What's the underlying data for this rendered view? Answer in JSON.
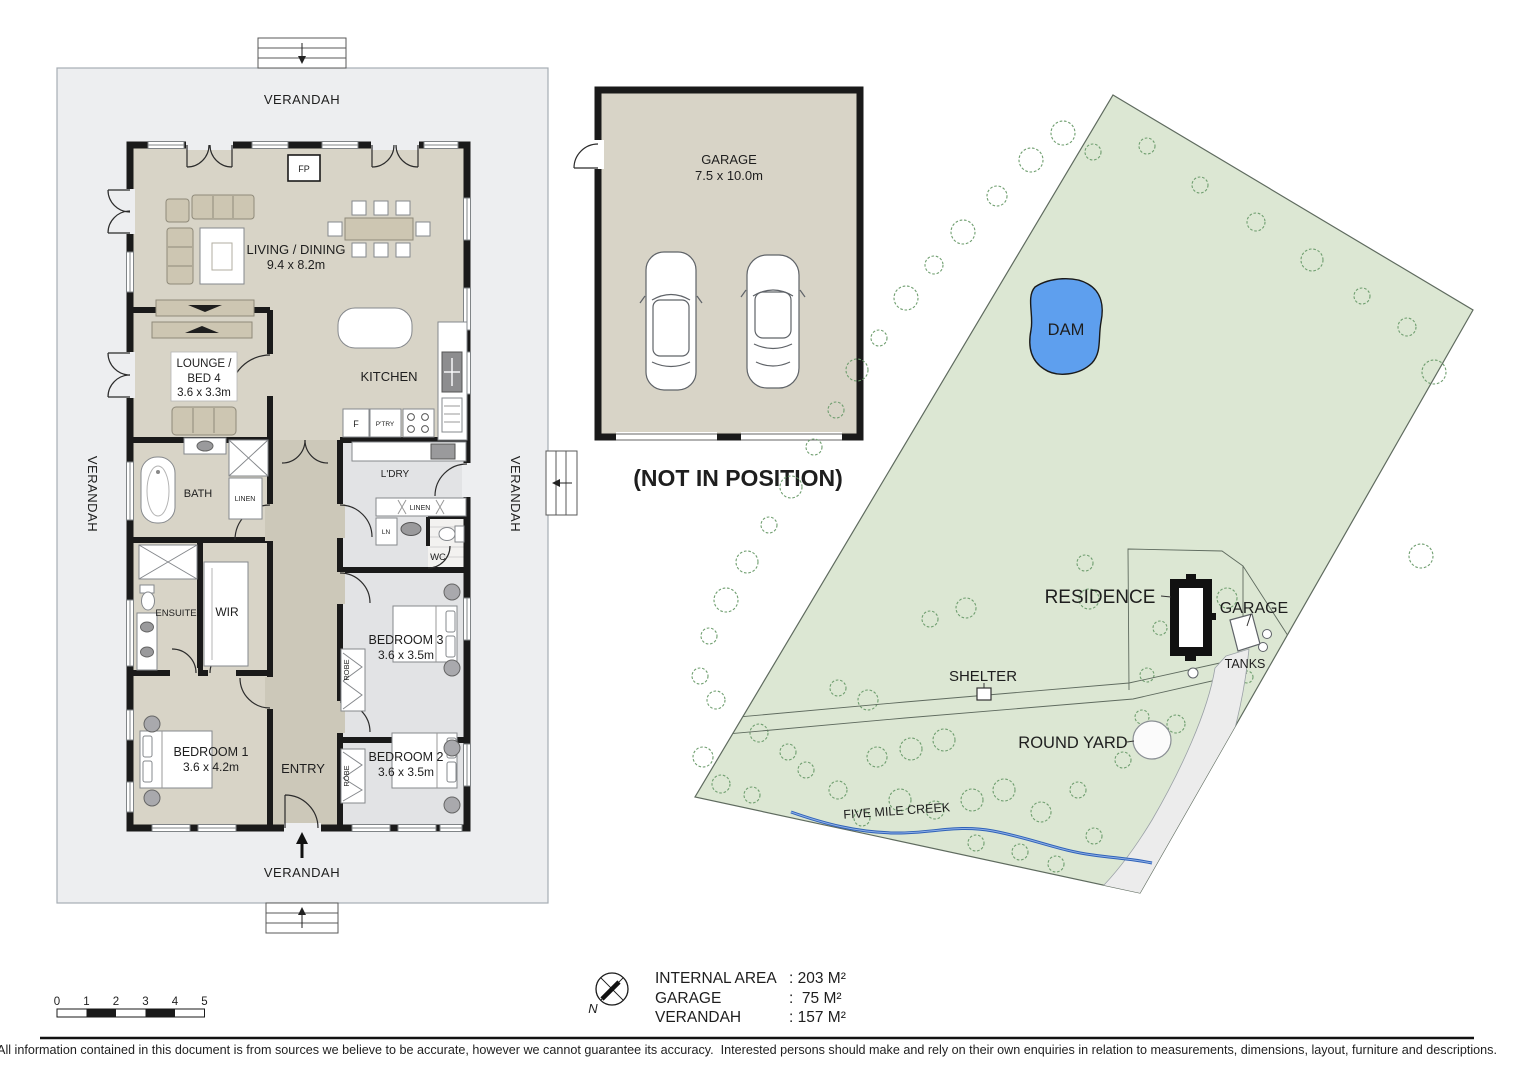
{
  "floor_plan": {
    "verandah": "VERANDAH",
    "rooms": {
      "living_dining": {
        "label": "LIVING / DINING",
        "dims": "9.4 x 8.2m"
      },
      "kitchen": "KITCHEN",
      "lounge_bed4": {
        "line1": "LOUNGE /",
        "line2": "BED 4",
        "dims": "3.6 x 3.3m"
      },
      "bath": "BATH",
      "ldry": "L'DRY",
      "linen": "LINEN",
      "ln": "LN",
      "wc": "WC",
      "ensuite": "ENSUITE",
      "wir": "WIR",
      "bedroom1": {
        "label": "BEDROOM 1",
        "dims": "3.6 x 4.2m"
      },
      "bedroom2": {
        "label": "BEDROOM 2",
        "dims": "3.6 x 3.5m"
      },
      "bedroom3": {
        "label": "BEDROOM 3",
        "dims": "3.6 x 3.5m"
      },
      "entry": "ENTRY",
      "robe": "ROBE",
      "fp": "FP",
      "fridge": "F",
      "pantry": "P'TRY"
    }
  },
  "garage_plan": {
    "label": "GARAGE",
    "dims": "7.5 x 10.0m",
    "note": "(NOT IN POSITION)"
  },
  "site_plan": {
    "dam": "DAM",
    "residence": "RESIDENCE",
    "garage": "GARAGE",
    "tanks": "TANKS",
    "shelter": "SHELTER",
    "round_yard": "ROUND YARD",
    "creek": "FIVE MILE CREEK"
  },
  "legend": {
    "scale_ticks": [
      "0",
      "1",
      "2",
      "3",
      "4",
      "5"
    ],
    "north": "N",
    "areas": [
      {
        "label": "INTERNAL AREA",
        "value": ": 203 M²"
      },
      {
        "label": "GARAGE",
        "value": ":  75 M²"
      },
      {
        "label": "VERANDAH",
        "value": ": 157 M²"
      }
    ]
  },
  "footer": {
    "disclaimer": "All information contained in this document is from sources we believe to be accurate, however we cannot guarantee its accuracy.  Interested persons should make and rely on their own enquiries in relation to measurements, dimensions, layout, furniture and descriptions."
  },
  "colors": {
    "site_green": "#dce7d3",
    "dam_blue": "#5e9fee",
    "creek_blue": "#2f62b8",
    "floor_beige": "#d8d4c7",
    "hall_beige": "#ccc8b9",
    "floor_grey": "#e2e3e5",
    "verandah_grey": "#edeef0",
    "wall_black": "#1a1a1a",
    "tree_green": "#6f9e6f"
  }
}
